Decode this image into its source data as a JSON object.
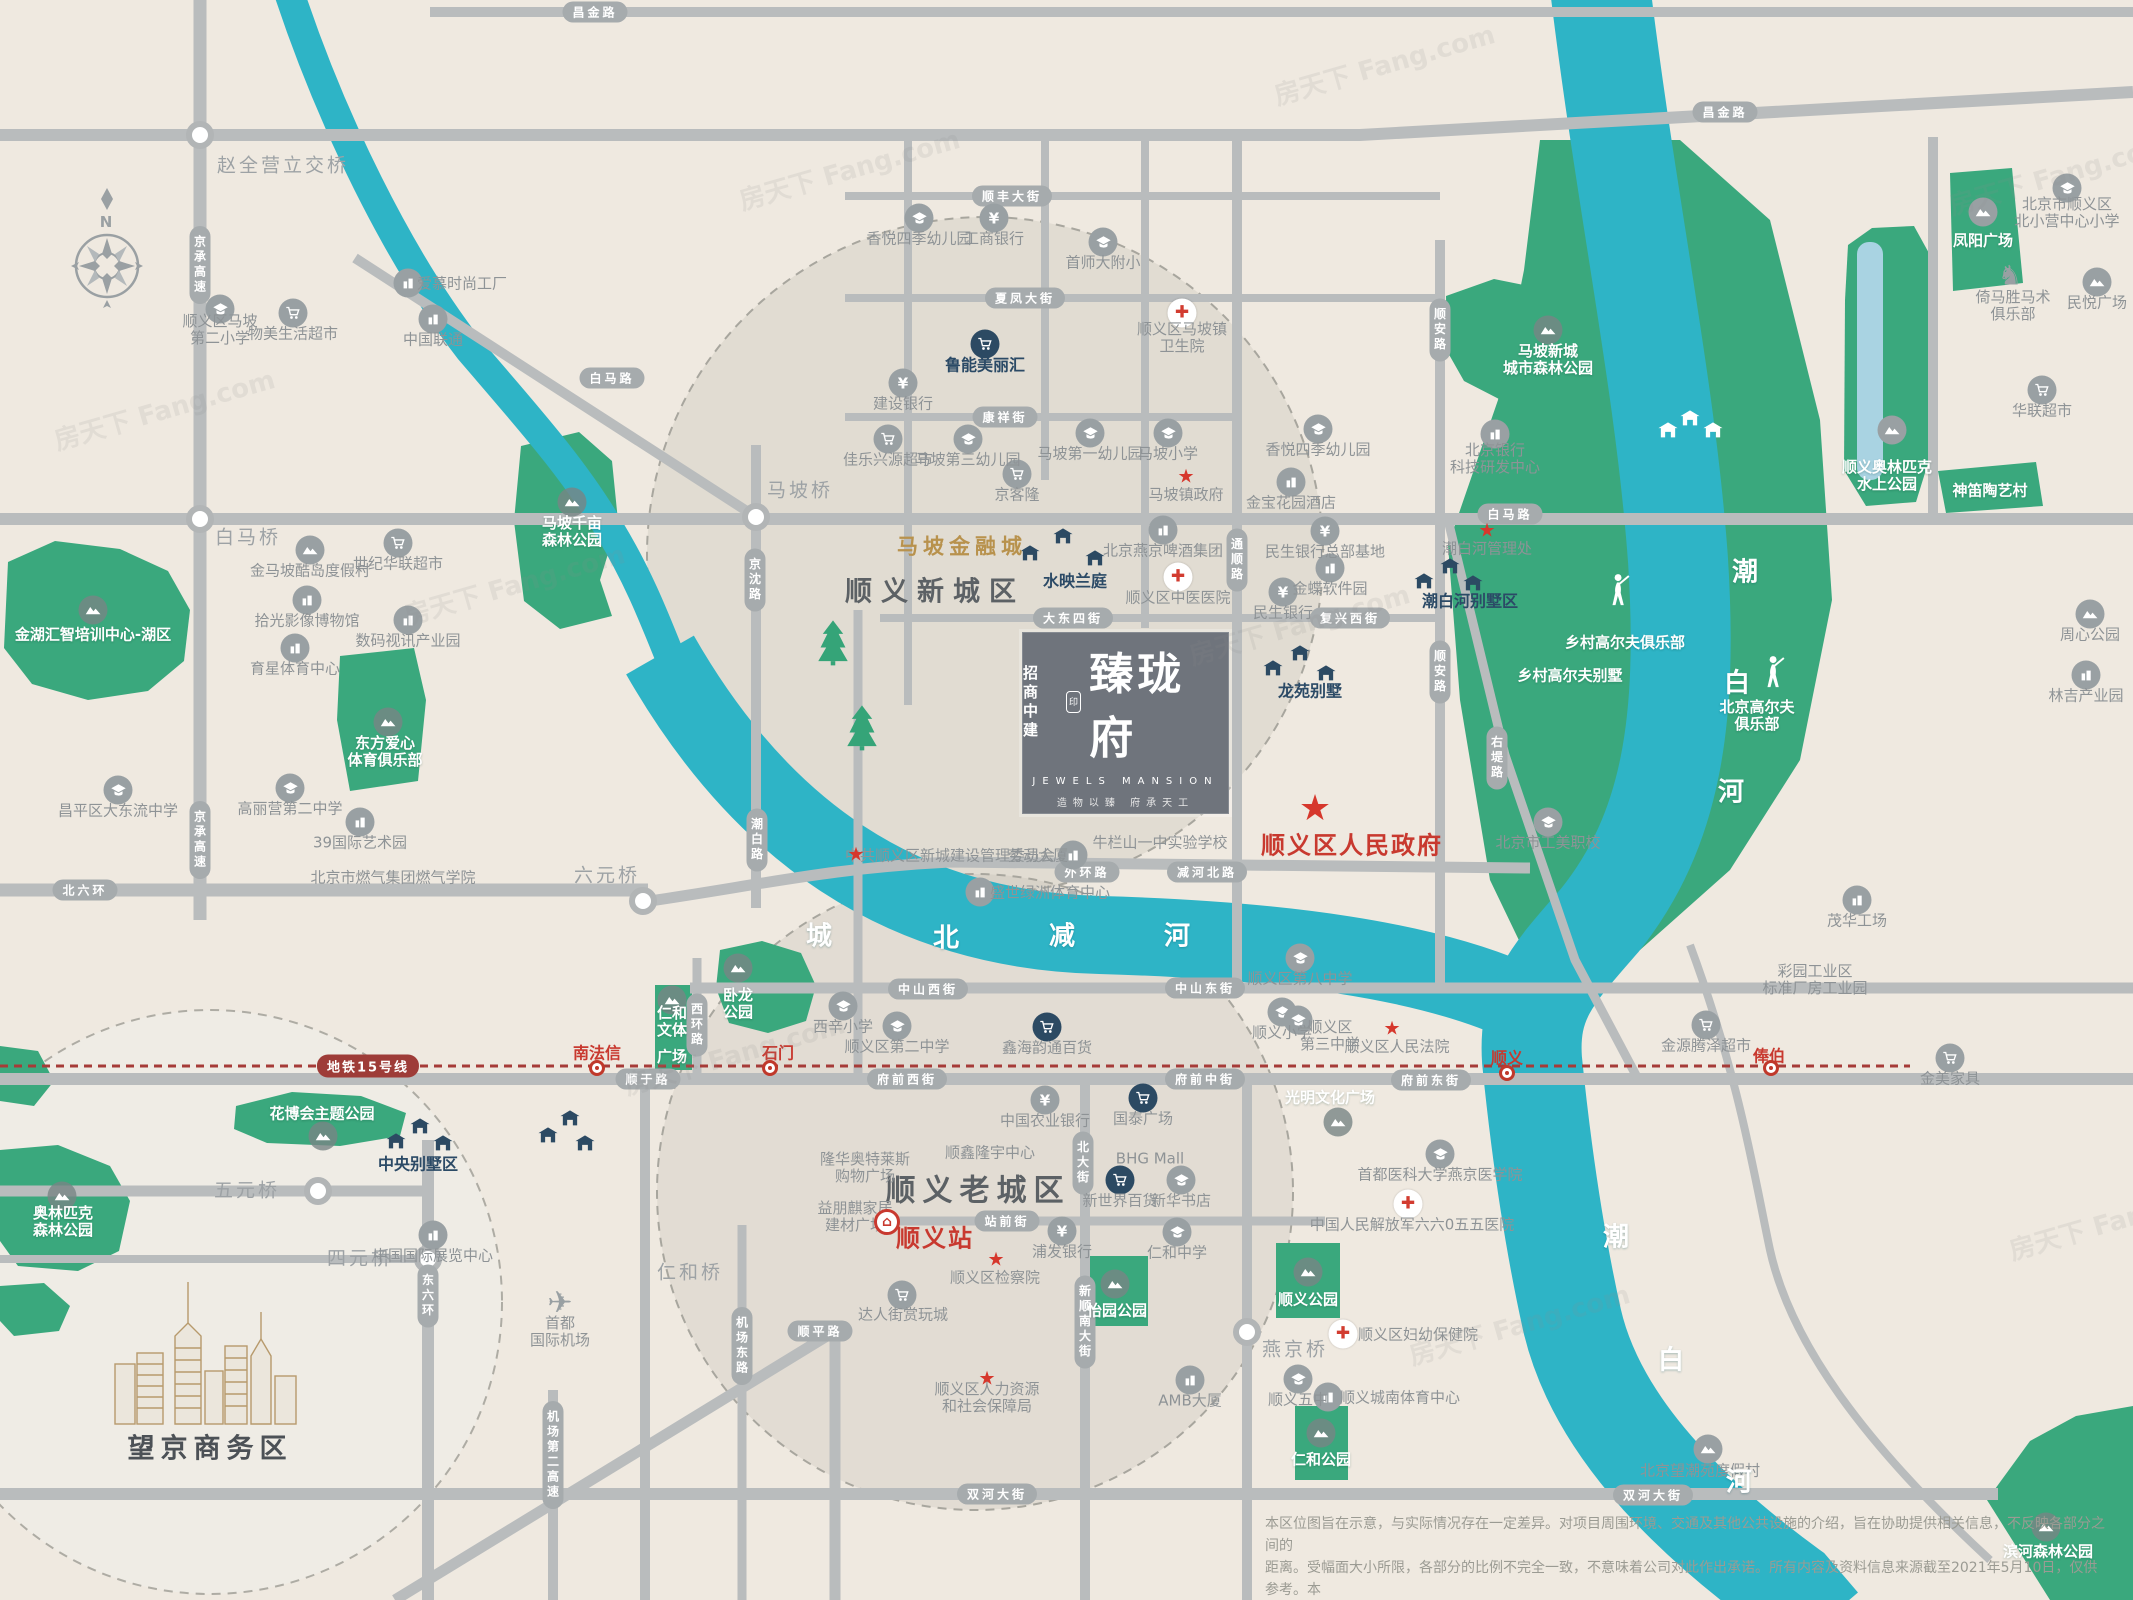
{
  "title": "招商中建臻珑府区位图",
  "colors": {
    "bg": "#efe9e0",
    "road": "#b9bcbd",
    "badge": "#a6abad",
    "river": "#2eb4c6",
    "park": "#3aa87d",
    "water_inner": "#a9d3e2",
    "metro": "#a63b38",
    "red": "#c8392f",
    "dark_icon": "#2c4a63",
    "gold": "#b8924d"
  },
  "compass": {
    "n": "N"
  },
  "project": {
    "brand_top": "招商",
    "brand_bottom": "中建",
    "seal": "印",
    "name": "臻珑府",
    "name_en": "JEWELS MANSION",
    "tagline": "造物以臻 府承天工"
  },
  "metro": {
    "badge_label": "地铁15号线",
    "stations": [
      {
        "n": "南法信",
        "x": 597,
        "y": 1053,
        "ix": 597,
        "iy": 1068
      },
      {
        "n": "石门",
        "x": 778,
        "y": 1053,
        "ix": 770,
        "iy": 1068
      },
      {
        "n": "顺义",
        "x": 1507,
        "y": 1058,
        "ix": 1507,
        "iy": 1073
      },
      {
        "n": "俸伯",
        "x": 1769,
        "y": 1056,
        "ix": 1771,
        "iy": 1068
      }
    ]
  },
  "watermark": "房天下 Fang.com",
  "watermarks": [
    {
      "x": 50,
      "y": 390
    },
    {
      "x": 400,
      "y": 565
    },
    {
      "x": 1185,
      "y": 605
    },
    {
      "x": 620,
      "y": 1035
    },
    {
      "x": 1405,
      "y": 1305
    },
    {
      "x": 1945,
      "y": 155
    },
    {
      "x": 1270,
      "y": 45
    },
    {
      "x": 735,
      "y": 150
    },
    {
      "x": 2005,
      "y": 1200
    }
  ],
  "disclaimer": {
    "line1": "本区位图旨在示意，与实际情况存在一定差异。对项目周围环境、交通及其他公共设施的介绍，旨在协助提供相关信息，不反映各部分之间的",
    "line2": "距离。受幅面大小所限，各部分的比例不完全一致，不意味着公司对此作出承诺。所有内容及资料信息来源截至2021年5月10日，仅供参考。本",
    "line3": "公司保留对广告图文修改的权利，敬请留意最新资料。本区位图发布时间为：2021年5月10日【广告】"
  },
  "road_badges": [
    {
      "n": "昌金路",
      "x": 595,
      "y": 12
    },
    {
      "n": "昌金路",
      "x": 1725,
      "y": 112
    },
    {
      "n": "京承高速",
      "x": 200,
      "y": 265,
      "v": 1
    },
    {
      "n": "京承高速",
      "x": 200,
      "y": 840,
      "v": 1
    },
    {
      "n": "白马路",
      "x": 612,
      "y": 378
    },
    {
      "n": "白马路",
      "x": 1510,
      "y": 514
    },
    {
      "n": "京沈路",
      "x": 755,
      "y": 580,
      "v": 1
    },
    {
      "n": "潮白路",
      "x": 757,
      "y": 840,
      "v": 1
    },
    {
      "n": "北六环",
      "x": 85,
      "y": 890
    },
    {
      "n": "顺丰大街",
      "x": 1012,
      "y": 196
    },
    {
      "n": "夏凤大街",
      "x": 1025,
      "y": 298
    },
    {
      "n": "康祥街",
      "x": 1005,
      "y": 417
    },
    {
      "n": "大东四街",
      "x": 1073,
      "y": 618
    },
    {
      "n": "复兴西街",
      "x": 1350,
      "y": 618
    },
    {
      "n": "通顺路",
      "x": 1237,
      "y": 560,
      "v": 1
    },
    {
      "n": "顺安路",
      "x": 1440,
      "y": 330,
      "v": 1
    },
    {
      "n": "顺安路",
      "x": 1440,
      "y": 672,
      "v": 1
    },
    {
      "n": "右堤路",
      "x": 1497,
      "y": 758,
      "v": 1
    },
    {
      "n": "外环路",
      "x": 1087,
      "y": 872
    },
    {
      "n": "减河北路",
      "x": 1207,
      "y": 872
    },
    {
      "n": "中山西街",
      "x": 928,
      "y": 989
    },
    {
      "n": "中山东街",
      "x": 1205,
      "y": 988
    },
    {
      "n": "西环路",
      "x": 697,
      "y": 1025,
      "v": 1
    },
    {
      "n": "顺于路",
      "x": 648,
      "y": 1079
    },
    {
      "n": "府前西街",
      "x": 907,
      "y": 1079
    },
    {
      "n": "府前中街",
      "x": 1205,
      "y": 1079
    },
    {
      "n": "府前东街",
      "x": 1431,
      "y": 1080
    },
    {
      "n": "站前街",
      "x": 1007,
      "y": 1221
    },
    {
      "n": "顺平路",
      "x": 820,
      "y": 1331
    },
    {
      "n": "机场东路",
      "x": 742,
      "y": 1346,
      "v": 1
    },
    {
      "n": "东六环",
      "x": 428,
      "y": 1296,
      "v": 1
    },
    {
      "n": "机场第二高速",
      "x": 553,
      "y": 1455,
      "v": 1
    },
    {
      "n": "北大街",
      "x": 1083,
      "y": 1163,
      "v": 1
    },
    {
      "n": "新顺南大街",
      "x": 1085,
      "y": 1322,
      "v": 1
    },
    {
      "n": "双河大街",
      "x": 997,
      "y": 1494
    },
    {
      "n": "双河大街",
      "x": 1653,
      "y": 1495
    }
  ],
  "pois": [
    {
      "n": "赵全营立交桥",
      "x": 283,
      "y": 166,
      "c": "bridge"
    },
    {
      "n": "白马桥",
      "x": 248,
      "y": 538,
      "c": "bridge"
    },
    {
      "n": "马坡桥",
      "x": 800,
      "y": 491,
      "c": "bridge"
    },
    {
      "n": "六元桥",
      "x": 607,
      "y": 876,
      "c": "bridge"
    },
    {
      "n": "五元桥",
      "x": 247,
      "y": 1191,
      "c": "bridge"
    },
    {
      "n": "四元桥",
      "x": 360,
      "y": 1259,
      "c": "bridge"
    },
    {
      "n": "仁和桥",
      "x": 690,
      "y": 1273,
      "c": "bridge"
    },
    {
      "n": "燕京桥",
      "x": 1295,
      "y": 1350,
      "c": "bridge"
    },
    {
      "n": "顺义区马坡",
      "l2": "第二小学",
      "x": 220,
      "y": 330,
      "i": "school"
    },
    {
      "n": "物美生活超市",
      "x": 293,
      "y": 334,
      "i": "cart"
    },
    {
      "n": "中国联通",
      "x": 433,
      "y": 340,
      "i": "building"
    },
    {
      "n": "爱慕时尚工厂",
      "x": 462,
      "y": 284,
      "i": "building",
      "ix": 408,
      "iy": 283
    },
    {
      "n": "金马坡酷岛度假村",
      "x": 310,
      "y": 571,
      "i": "mountain"
    },
    {
      "n": "世纪华联超市",
      "x": 398,
      "y": 564,
      "i": "cart"
    },
    {
      "n": "拾光影像博物馆",
      "x": 307,
      "y": 621,
      "i": "building"
    },
    {
      "n": "数码视讯产业园",
      "x": 408,
      "y": 641,
      "i": "building"
    },
    {
      "n": "育星体育中心",
      "x": 295,
      "y": 669,
      "i": "building"
    },
    {
      "n": "昌平区大东流中学",
      "x": 118,
      "y": 811,
      "i": "school"
    },
    {
      "n": "高丽营第二中学",
      "x": 290,
      "y": 809,
      "i": "school"
    },
    {
      "n": "39国际艺术园",
      "x": 360,
      "y": 843,
      "i": "building"
    },
    {
      "n": "北京市燃气集团燃气学院",
      "x": 393,
      "y": 878
    },
    {
      "n": "金湖汇智培训中心-湖区",
      "x": 93,
      "y": 635,
      "c": "w",
      "i": "mountainW",
      "ix": 93,
      "iy": 610
    },
    {
      "n": "东方爱心",
      "l2": "体育俱乐部",
      "x": 385,
      "y": 752,
      "c": "w",
      "i": "mountainW",
      "ix": 388,
      "iy": 722
    },
    {
      "n": "马坡千亩",
      "l2": "森林公园",
      "x": 572,
      "y": 532,
      "c": "w",
      "i": "mountainW",
      "ix": 572,
      "iy": 502
    },
    {
      "n": "花博会主题公园",
      "x": 322,
      "y": 1114,
      "c": "w",
      "i": "mountainW",
      "ix": 323,
      "iy": 1136
    },
    {
      "n": "奥林匹克",
      "l2": "森林公园",
      "x": 63,
      "y": 1222,
      "c": "w",
      "i": "mountainW",
      "ix": 62,
      "iy": 1196
    },
    {
      "n": "中央别墅区",
      "x": 418,
      "y": 1164,
      "c": "d"
    },
    {
      "n": "首都",
      "l2": "国际机场",
      "x": 560,
      "y": 1332,
      "i": "plane",
      "ix": 560,
      "iy": 1303
    },
    {
      "n": "中国国际展览中心",
      "x": 433,
      "y": 1256,
      "i": "building"
    },
    {
      "n": "望京商务区",
      "x": 210,
      "y": 1449,
      "c": "wj"
    },
    {
      "n": "香悦四季幼儿园",
      "x": 919,
      "y": 239,
      "i": "school"
    },
    {
      "n": "工商银行",
      "x": 994,
      "y": 239,
      "i": "bank"
    },
    {
      "n": "首师大附小",
      "x": 1103,
      "y": 263,
      "i": "school"
    },
    {
      "n": "鲁能美丽汇",
      "x": 985,
      "y": 365,
      "c": "d",
      "i": "cartD"
    },
    {
      "n": "建设银行",
      "x": 903,
      "y": 404,
      "i": "bank"
    },
    {
      "n": "顺义区马坡镇",
      "l2": "卫生院",
      "x": 1182,
      "y": 338,
      "i": "hospital",
      "ix": 1182,
      "iy": 313
    },
    {
      "n": "佳乐兴源超市",
      "x": 888,
      "y": 460,
      "i": "cart"
    },
    {
      "n": "马坡第三幼儿园",
      "x": 968,
      "y": 460,
      "i": "school"
    },
    {
      "n": "马坡第一幼儿园",
      "x": 1090,
      "y": 454,
      "i": "school"
    },
    {
      "n": "马坡小学",
      "x": 1168,
      "y": 454,
      "i": "school"
    },
    {
      "n": "京客隆",
      "x": 1017,
      "y": 495,
      "i": "cart"
    },
    {
      "n": "马坡镇政府",
      "x": 1186,
      "y": 495,
      "i": "star",
      "ix": 1186,
      "iy": 477
    },
    {
      "n": "香悦四季幼儿园",
      "x": 1318,
      "y": 450,
      "i": "school"
    },
    {
      "n": "金宝花园酒店",
      "x": 1291,
      "y": 503,
      "i": "building"
    },
    {
      "n": "北京银行",
      "l2": "科技研发中心",
      "x": 1495,
      "y": 459,
      "i": "building",
      "ix": 1495,
      "iy": 434
    },
    {
      "n": "马坡新城",
      "l2": "城市森林公园",
      "x": 1548,
      "y": 360,
      "c": "w",
      "i": "mountainW",
      "ix": 1548,
      "iy": 330
    },
    {
      "n": "水映兰庭",
      "x": 1075,
      "y": 581,
      "c": "d"
    },
    {
      "n": "北京燕京啤酒集团",
      "x": 1163,
      "y": 551,
      "i": "building"
    },
    {
      "n": "顺义区中医医院",
      "x": 1178,
      "y": 598,
      "i": "hospital"
    },
    {
      "n": "民生银行总部基地",
      "x": 1325,
      "y": 552,
      "i": "bank"
    },
    {
      "n": "金蝶软件园",
      "x": 1330,
      "y": 589,
      "i": "building"
    },
    {
      "n": "民生银行",
      "x": 1283,
      "y": 613,
      "i": "bank"
    },
    {
      "n": "龙苑别墅",
      "x": 1310,
      "y": 691,
      "c": "d"
    },
    {
      "n": "潮白河别墅区",
      "x": 1470,
      "y": 601,
      "c": "d"
    },
    {
      "n": "潮白河管理处",
      "x": 1487,
      "y": 549,
      "i": "star",
      "ix": 1487,
      "iy": 531
    },
    {
      "n": "乡村高尔夫俱乐部",
      "x": 1625,
      "y": 643,
      "c": "w",
      "i": "golfer",
      "ix": 1617,
      "iy": 590
    },
    {
      "n": "乡村高尔夫别墅",
      "x": 1570,
      "y": 676,
      "c": "w"
    },
    {
      "n": "北京高尔夫",
      "l2": "俱乐部",
      "x": 1757,
      "y": 716,
      "c": "w",
      "i": "golfer",
      "ix": 1772,
      "iy": 672
    },
    {
      "n": "中共顺义区新城建设管理委员会",
      "x": 950,
      "y": 856,
      "i": "star",
      "ix": 856,
      "iy": 855
    },
    {
      "n": "劳动大厦",
      "x": 1038,
      "y": 856,
      "i": "building",
      "ix": 1073,
      "iy": 855
    },
    {
      "n": "牛栏山一中实验学校",
      "x": 1160,
      "y": 843
    },
    {
      "n": "盛世绿洲体育中心",
      "x": 1050,
      "y": 893,
      "i": "building",
      "ix": 980,
      "iy": 892
    },
    {
      "n": "顺义区第八中学",
      "x": 1300,
      "y": 979,
      "i": "school"
    },
    {
      "n": "顺义小学",
      "x": 1282,
      "y": 1033,
      "i": "school"
    },
    {
      "n": "顺义区",
      "l2": "第三中学",
      "x": 1330,
      "y": 1036,
      "i": "school",
      "ix": 1298,
      "iy": 1020
    },
    {
      "n": "顺义区人民法院",
      "x": 1397,
      "y": 1047,
      "i": "star",
      "ix": 1392,
      "iy": 1029
    },
    {
      "n": "鑫海韵通百货",
      "x": 1047,
      "y": 1048,
      "i": "cartD"
    },
    {
      "n": "西辛小学",
      "x": 843,
      "y": 1027,
      "i": "school"
    },
    {
      "n": "顺义区第二中学",
      "x": 897,
      "y": 1047,
      "i": "school"
    },
    {
      "n": "卧龙",
      "l2": "公园",
      "x": 738,
      "y": 1004,
      "c": "w",
      "i": "mountainW",
      "ix": 738,
      "iy": 968
    },
    {
      "n": "仁和",
      "l2": "文体",
      "x": 672,
      "y": 1022,
      "c": "w",
      "i": "mountainW",
      "ix": 672,
      "iy": 1000
    },
    {
      "n": "广场",
      "x": 672,
      "y": 1057,
      "c": "w"
    },
    {
      "n": "光明文化广场",
      "x": 1330,
      "y": 1098,
      "c": "w",
      "i": "mountainW",
      "ix": 1338,
      "iy": 1122
    },
    {
      "n": "首都医科大学燕京医学院",
      "x": 1440,
      "y": 1175,
      "i": "school"
    },
    {
      "n": "中国人民解放军六六0五五医院",
      "x": 1412,
      "y": 1225,
      "i": "hospital",
      "ix": 1408,
      "iy": 1204
    },
    {
      "n": "金源腾泽超市",
      "x": 1706,
      "y": 1046,
      "i": "cart"
    },
    {
      "n": "彩园工业区",
      "l2": "标准厂房工业园",
      "x": 1815,
      "y": 980
    },
    {
      "n": "金美家具",
      "x": 1950,
      "y": 1079,
      "i": "cart"
    },
    {
      "n": "茂华工场",
      "x": 1857,
      "y": 921,
      "i": "building"
    },
    {
      "n": "周心公园",
      "x": 2090,
      "y": 635,
      "i": "mountain"
    },
    {
      "n": "林吉产业园",
      "x": 2086,
      "y": 696,
      "i": "building"
    },
    {
      "n": "北京市工美职校",
      "x": 1548,
      "y": 843,
      "i": "school"
    },
    {
      "n": "北京市顺义区",
      "l2": "北小营中心小学",
      "x": 2067,
      "y": 213,
      "i": "school",
      "ix": 2067,
      "iy": 188
    },
    {
      "n": "倚马胜马术",
      "l2": "俱乐部",
      "x": 2013,
      "y": 306,
      "i": "horse",
      "ix": 2010,
      "iy": 276
    },
    {
      "n": "民悦广场",
      "x": 2097,
      "y": 303,
      "i": "mountain"
    },
    {
      "n": "华联超市",
      "x": 2042,
      "y": 411,
      "i": "cart"
    },
    {
      "n": "凤阳广场",
      "x": 1983,
      "y": 241,
      "c": "w",
      "i": "mountain",
      "ix": 1983,
      "iy": 212
    },
    {
      "n": "顺义奥林匹克",
      "l2": "水上公园",
      "x": 1887,
      "y": 476,
      "c": "w",
      "i": "mountain",
      "ix": 1892,
      "iy": 430
    },
    {
      "n": "神笛陶艺村",
      "x": 1990,
      "y": 491,
      "c": "w"
    },
    {
      "n": "顺义区人民政府",
      "x": 1352,
      "y": 846,
      "c": "rbig",
      "i": "starbig",
      "ix": 1315,
      "iy": 809
    },
    {
      "n": "顺义站",
      "x": 935,
      "y": 1239,
      "c": "rbig",
      "i": "trainstn",
      "ix": 887,
      "iy": 1222
    },
    {
      "n": "顺义老城区",
      "x": 978,
      "y": 1191,
      "c": "big2"
    },
    {
      "n": "顺义新城区",
      "x": 935,
      "y": 592,
      "c": "big"
    },
    {
      "n": "马坡金融城",
      "x": 962,
      "y": 547,
      "c": "gold"
    },
    {
      "n": "隆华奥特莱斯",
      "l2": "购物广场",
      "x": 865,
      "y": 1168
    },
    {
      "n": "益朋麒家居",
      "l2": "建材广场",
      "x": 855,
      "y": 1217
    },
    {
      "n": "顺鑫隆宇中心",
      "x": 990,
      "y": 1153
    },
    {
      "n": "中国农业银行",
      "x": 1045,
      "y": 1121,
      "i": "bank"
    },
    {
      "n": "国泰广场",
      "x": 1143,
      "y": 1119,
      "i": "cartD"
    },
    {
      "n": "BHG Mall",
      "x": 1150,
      "y": 1159
    },
    {
      "n": "新世界百货",
      "x": 1120,
      "y": 1201,
      "i": "cartD"
    },
    {
      "n": "新华书店",
      "x": 1181,
      "y": 1201,
      "i": "school"
    },
    {
      "n": "浦发银行",
      "x": 1062,
      "y": 1252,
      "i": "bank"
    },
    {
      "n": "顺义区检察院",
      "x": 995,
      "y": 1278,
      "i": "star",
      "ix": 996,
      "iy": 1260
    },
    {
      "n": "仁和中学",
      "x": 1177,
      "y": 1253,
      "i": "school"
    },
    {
      "n": "达人街赏玩城",
      "x": 903,
      "y": 1315,
      "i": "cart",
      "ix": 902,
      "iy": 1295
    },
    {
      "n": "顺义区人力资源",
      "l2": "和社会保障局",
      "x": 987,
      "y": 1398,
      "i": "star",
      "ix": 987,
      "iy": 1379
    },
    {
      "n": "AMB大厦",
      "x": 1190,
      "y": 1401,
      "i": "building"
    },
    {
      "n": "顺义五中",
      "x": 1298,
      "y": 1400,
      "i": "school"
    },
    {
      "n": "顺义区妇幼保健院",
      "x": 1418,
      "y": 1335,
      "i": "hospital",
      "ix": 1343,
      "iy": 1334
    },
    {
      "n": "顺义城南体育中心",
      "x": 1400,
      "y": 1398,
      "i": "building",
      "ix": 1328,
      "iy": 1397
    },
    {
      "n": "怡园公园",
      "x": 1117,
      "y": 1311,
      "c": "w",
      "i": "mountainW",
      "ix": 1115,
      "iy": 1284
    },
    {
      "n": "顺义公园",
      "x": 1308,
      "y": 1300,
      "c": "w",
      "i": "mountainW",
      "ix": 1308,
      "iy": 1272
    },
    {
      "n": "仁和公园",
      "x": 1321,
      "y": 1460,
      "c": "w",
      "i": "mountainW",
      "ix": 1321,
      "iy": 1433
    },
    {
      "n": "滨河森林公园",
      "x": 2048,
      "y": 1552,
      "c": "w",
      "i": "mountainW",
      "ix": 2046,
      "iy": 1527
    },
    {
      "n": "北京望潮苑度假村",
      "x": 1700,
      "y": 1471,
      "i": "mountain",
      "ix": 1708,
      "iy": 1449
    },
    {
      "n": "城",
      "x": 820,
      "y": 937,
      "c": "wr"
    },
    {
      "n": "北",
      "x": 947,
      "y": 939,
      "c": "wr"
    },
    {
      "n": "减",
      "x": 1063,
      "y": 937,
      "c": "wr"
    },
    {
      "n": "河",
      "x": 1178,
      "y": 937,
      "c": "wr"
    },
    {
      "n": "潮",
      "x": 1746,
      "y": 573,
      "c": "wr"
    },
    {
      "n": "白",
      "x": 1738,
      "y": 684,
      "c": "wr"
    },
    {
      "n": "河",
      "x": 1732,
      "y": 793,
      "c": "wr"
    },
    {
      "n": "潮",
      "x": 1617,
      "y": 1238,
      "c": "wr"
    },
    {
      "n": "白",
      "x": 1672,
      "y": 1361,
      "c": "wr"
    },
    {
      "n": "河",
      "x": 1740,
      "y": 1483,
      "c": "wr"
    }
  ],
  "villas": {
    "dark": [
      [
        1063,
        538
      ],
      [
        1030,
        555
      ],
      [
        1095,
        560
      ],
      [
        1300,
        655
      ],
      [
        1273,
        670
      ],
      [
        1326,
        675
      ],
      [
        1450,
        568
      ],
      [
        1424,
        583
      ],
      [
        1473,
        585
      ],
      [
        420,
        1128
      ],
      [
        396,
        1143
      ],
      [
        443,
        1145
      ],
      [
        570,
        1120
      ],
      [
        548,
        1137
      ],
      [
        585,
        1145
      ]
    ],
    "white": [
      [
        1690,
        420
      ],
      [
        1713,
        432
      ],
      [
        1668,
        432
      ]
    ]
  },
  "trees": [
    [
      833,
      645
    ],
    [
      862,
      730
    ]
  ]
}
